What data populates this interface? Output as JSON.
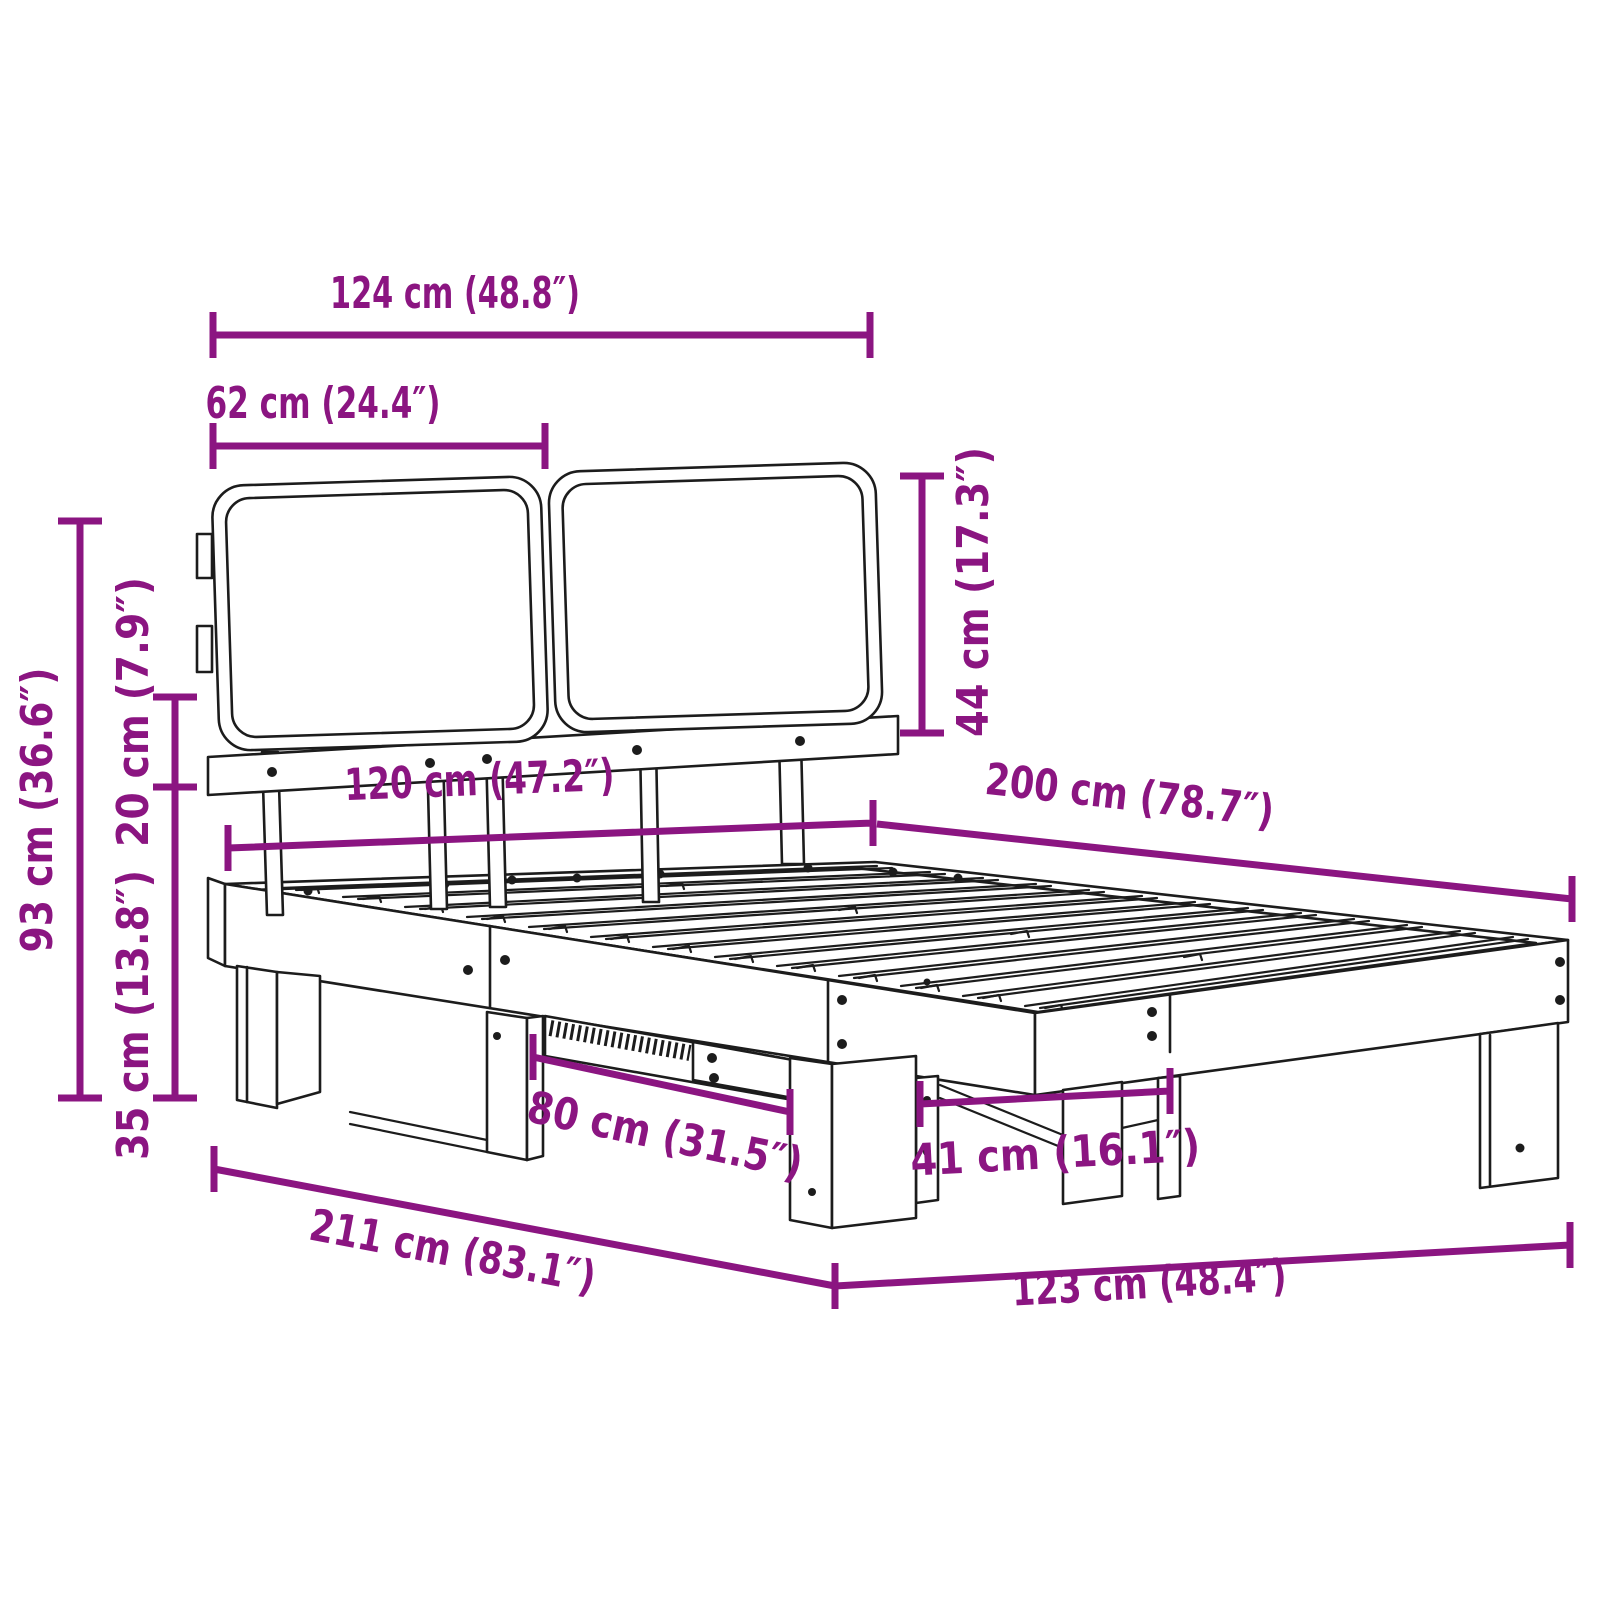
{
  "diagram": {
    "kind": "product dimension diagram",
    "subject": "bed frame with slatted base and two headboard cushions",
    "accent_color": "#8B1581",
    "line_color": "#1c1c1c",
    "background_color": "#ffffff",
    "unit_primary": "cm",
    "unit_secondary": "inches"
  },
  "dimensions": [
    {
      "id": "headboard-total-width",
      "cm": 124,
      "inches": 48.8,
      "label": "124 cm (48.8″)"
    },
    {
      "id": "headboard-cushion-width",
      "cm": 62,
      "inches": 24.4,
      "label": "62 cm (24.4″)"
    },
    {
      "id": "headboard-cushion-height",
      "cm": 44,
      "inches": 17.3,
      "label": "44 cm (17.3″)"
    },
    {
      "id": "overall-height",
      "cm": 93,
      "inches": 36.6,
      "label": "93 cm (36.6″)"
    },
    {
      "id": "cushion-to-frame-gap",
      "cm": 20,
      "inches": 7.9,
      "label": "20 cm (7.9″)"
    },
    {
      "id": "frame-height",
      "cm": 35,
      "inches": 13.8,
      "label": "35 cm (13.8″)"
    },
    {
      "id": "mattress-width",
      "cm": 120,
      "inches": 47.2,
      "label": "120 cm (47.2″)"
    },
    {
      "id": "mattress-length",
      "cm": 200,
      "inches": 78.7,
      "label": "200 cm (78.7″)"
    },
    {
      "id": "side-leg-spacing",
      "cm": 80,
      "inches": 31.5,
      "label": "80 cm (31.5″)"
    },
    {
      "id": "foot-leg-spacing",
      "cm": 41,
      "inches": 16.1,
      "label": "41 cm (16.1″)"
    },
    {
      "id": "overall-length",
      "cm": 211,
      "inches": 83.1,
      "label": "211 cm (83.1″)"
    },
    {
      "id": "overall-width",
      "cm": 123,
      "inches": 48.4,
      "label": "123 cm (48.4″)"
    }
  ]
}
